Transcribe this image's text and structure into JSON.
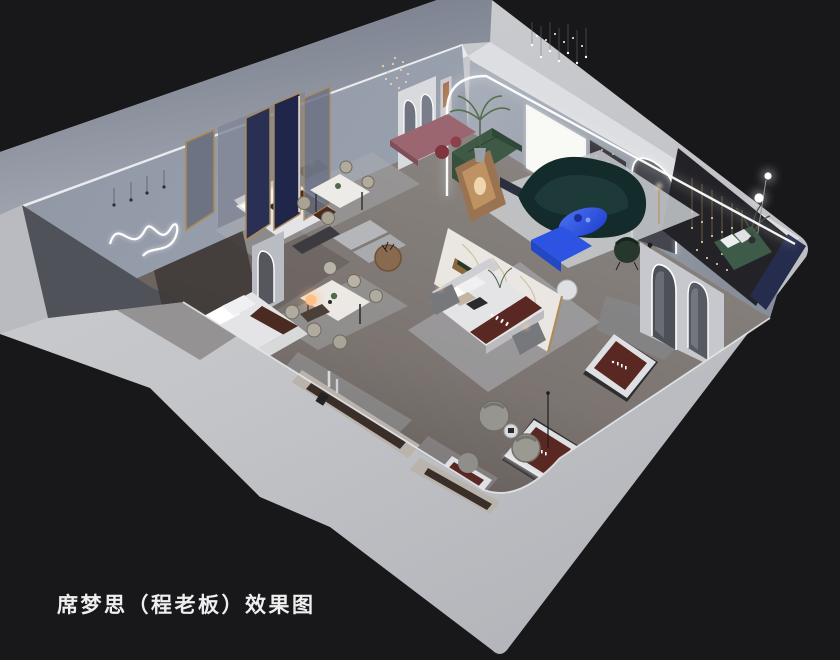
{
  "caption": {
    "text": "席梦思（程老板）效果图"
  },
  "palette": {
    "c-bg": "#18181a",
    "c-outer": "#c5c7cb",
    "c-wall-top": "#e9ebee",
    "c-wall-blue": "#98a0ad",
    "c-walkway": "#7e8492",
    "c-floor": "#746b66",
    "c-rug": "#abaeb2",
    "c-marble": "#eae7e2",
    "c-gold": "#ad8a54",
    "c-navy": "#262c4d",
    "c-charcoal": "#232327",
    "c-led": "#ffffff",
    "c-blue": "#2d53e3",
    "c-green-sofa": "#3e5a46",
    "c-teal-sofa": "#132b2a",
    "c-mauve": "#9c6670",
    "c-wood": "#8a6a4e",
    "c-burgundy": "#5a2822",
    "c-runner": "#4a2a21",
    "c-bed-white": "#e4e4e7",
    "c-terracotta": "#b2613c",
    "c-lamp-warm": "#ffb36e"
  },
  "scene": {
    "type": "isometric-interior-render",
    "elements": [
      "showroom-cutaway",
      "outer-walls",
      "exterior-walkway",
      "neon-squiggle-wall-art",
      "navy-gold-partitions",
      "arched-niche-wall",
      "led-arch-wall",
      "backlit-panel",
      "string-light-chandelier",
      "green-sectional-sofa",
      "teal-curved-sofa",
      "blue-oval-coffee-table",
      "blue-media-console",
      "marble-feature-wall",
      "hero-bed",
      "display-beds",
      "dining-table-set-a",
      "dining-table-set-b",
      "round-wood-table",
      "mauve-bench",
      "charcoal-feature-wall",
      "cascading-string-lights",
      "arched-mirrors",
      "display-mattresses",
      "swivel-armchairs",
      "orange-glow-lamp",
      "floor-orb-lamp",
      "green-bench",
      "potted-plants"
    ]
  }
}
